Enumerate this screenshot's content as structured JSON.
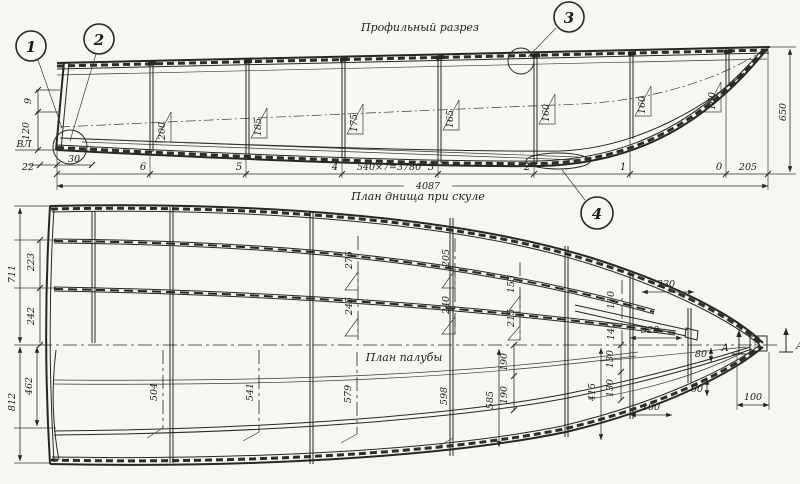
{
  "colors": {
    "paper": "#f7f6f1",
    "ink": "#262626"
  },
  "profile": {
    "title": "Профильный разрез",
    "callouts": {
      "c1": "1",
      "c2": "2",
      "c3": "3",
      "c4": "4"
    },
    "left_dims": {
      "d9": "9",
      "d120": "120",
      "waterline": "ВЛ",
      "d22": "22",
      "d30": "30"
    },
    "frame_flags": [
      "200",
      "185",
      "175",
      "165",
      "160",
      "160",
      "160"
    ],
    "stations": [
      "6",
      "5",
      "4",
      "3",
      "2",
      "1",
      "0"
    ],
    "dims": {
      "spacing": "540×7=3780",
      "total": "4087",
      "bow": "205",
      "height": "650"
    }
  },
  "plan": {
    "chine_title": "План днища при скуле",
    "deck_title": "План палубы",
    "left_dims": {
      "d711": "711",
      "d223": "223",
      "d242": "242",
      "d462": "462",
      "d812": "812"
    },
    "chine_dims": {
      "s4_top": "275",
      "s4_bot": "245",
      "s3_top": "205",
      "s3_bot": "240",
      "s2_top": "153",
      "s2_bot": "215",
      "bow_top": "110",
      "bow_bot": "140",
      "d330": "330",
      "d320": "320"
    },
    "deck_dims": {
      "f504": "504",
      "f541": "541",
      "f579": "579",
      "f598": "598",
      "f585": "585",
      "d190a": "190",
      "d190b": "190",
      "d130a": "130",
      "d130b": "130",
      "d415": "415",
      "d100a": "100",
      "d80": "80",
      "d60": "60",
      "d100b": "100"
    },
    "section_markers": {
      "left": "А",
      "right": "А"
    }
  }
}
